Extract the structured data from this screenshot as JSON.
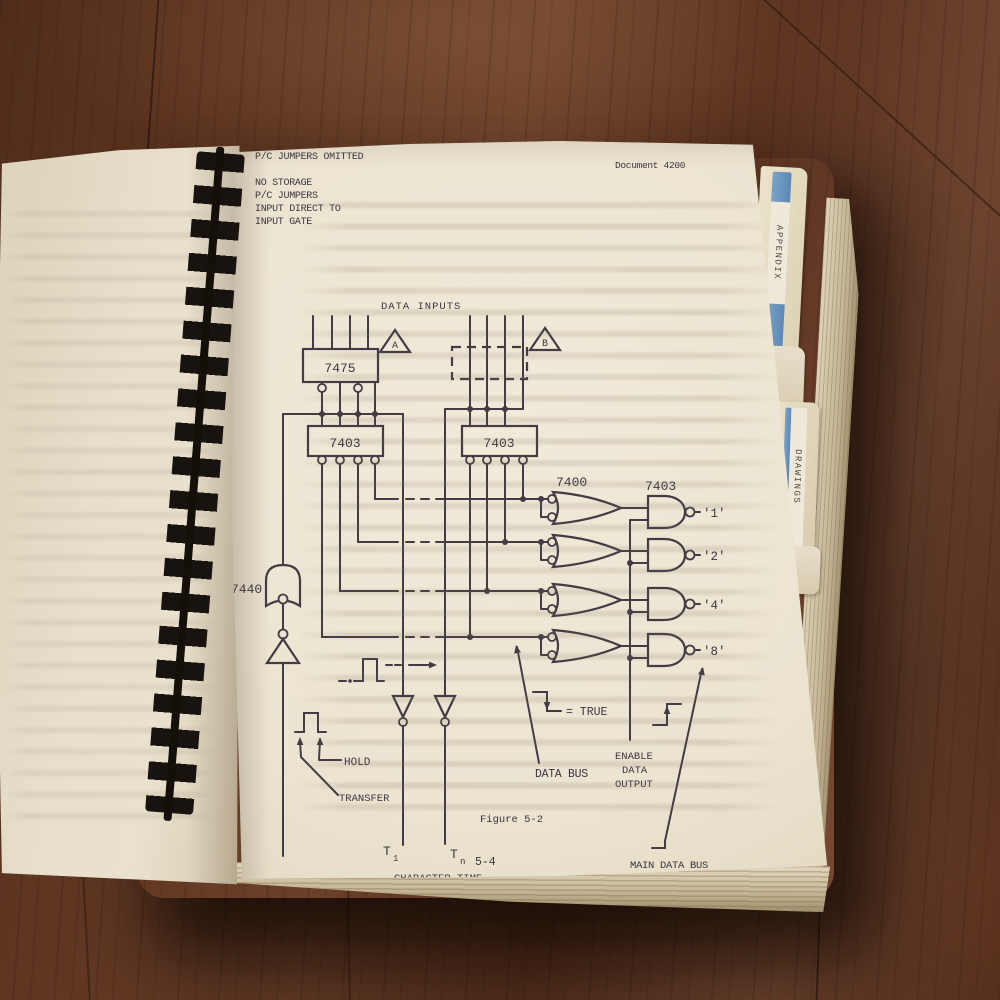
{
  "header": {
    "document_label": "Document 4200"
  },
  "legend": {
    "a_key": "A",
    "a_lines": [
      "STORAGE INSTALLED",
      "P/C JUMPERS OMITTED"
    ],
    "b_key": "B",
    "b_lines": [
      "NO STORAGE",
      "P/C JUMPERS",
      "INPUT DIRECT TO",
      "INPUT GATE"
    ]
  },
  "diagram": {
    "data_inputs_label": "DATA INPUTS",
    "marker_a": "A",
    "marker_b": "B",
    "ic_7475": "7475",
    "ic_7403_left": "7403",
    "ic_7403_right": "7403",
    "ic_7400": "7400",
    "ic_7403_out": "7403",
    "ic_7440": "7440",
    "out_1": "'1'",
    "out_2": "'2'",
    "out_4": "'4'",
    "out_8": "'8'",
    "hold_label": "HOLD",
    "transfer_label": "TRANSFER",
    "true_label": "= TRUE",
    "data_bus_label": "DATA BUS",
    "enable_line1": "ENABLE",
    "enable_line2": "DATA",
    "enable_line3": "OUTPUT",
    "main_data_bus_label": "MAIN DATA BUS",
    "t_first": "T",
    "t_first_sub": "1",
    "t_last": "T",
    "t_last_sub": "n",
    "character_time_label": "CHARACTER TIME"
  },
  "captions": {
    "figure": "Figure 5-2",
    "page": "5-4"
  },
  "tabs": {
    "top": "APPENDIX",
    "bottom": "DRAWINGS"
  },
  "colors": {
    "tab_blue": "#6a93bd",
    "ink": "#3d3640",
    "page": "#ece4d1",
    "wood": "#5d3521"
  }
}
